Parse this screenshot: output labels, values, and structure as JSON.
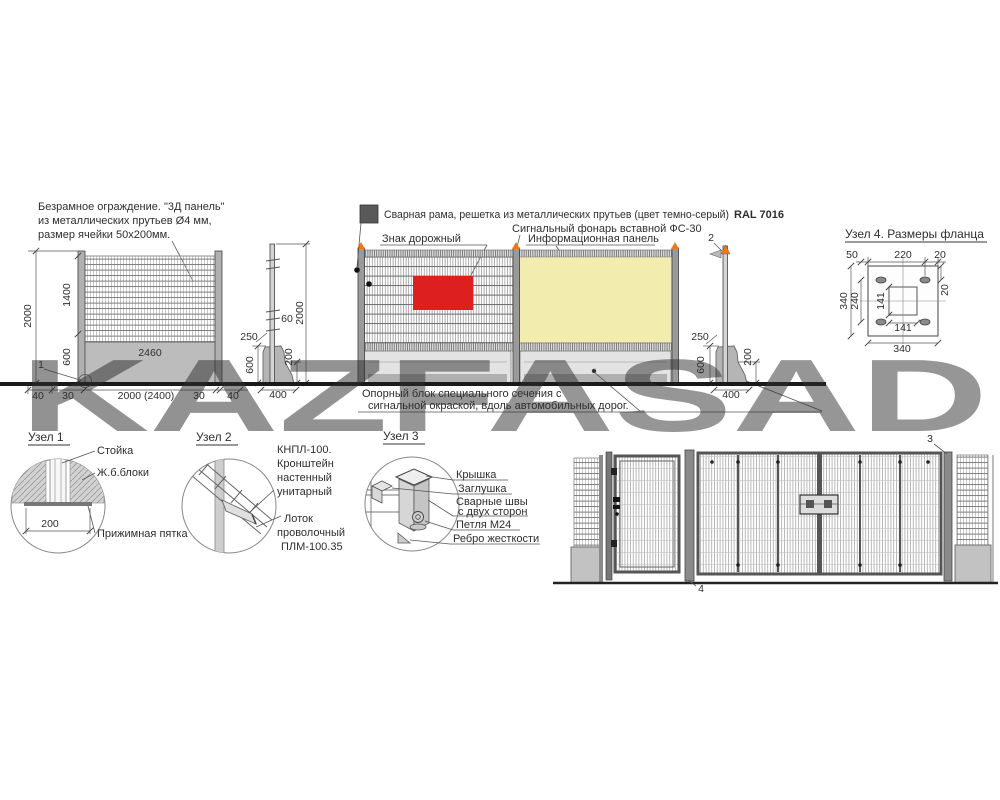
{
  "colors": {
    "sign_red": "#dd1f1f",
    "info_yellow": "#f2ecae",
    "lantern_orange": "#e8791e",
    "frame_swatch_gray": "#595959",
    "watermark_red": "#b33a33",
    "watermark_gray": "#9c9c9c"
  },
  "fence3d": {
    "description_line1": "Безрамное ограждение. \"3Д панель\"",
    "description_line2": "из металлических прутьев Ø4 мм,",
    "description_line3": "размер ячейки 50x200мм.",
    "dim_height_total": "2000",
    "dim_mesh_height": "1400",
    "dim_base_height": "600",
    "dim_block_width": "2460",
    "dim_edge_left": "40",
    "dim_gap_left": "30",
    "dim_span": "2000 (2400)",
    "dim_gap_right": "30",
    "dim_edge_right": "40",
    "item_no": "1"
  },
  "side1": {
    "dim_bracket": "60",
    "dim_height": "2000",
    "dim_top": "250",
    "dim_base_height": "600",
    "dim_base_top": "200",
    "dim_base_width": "400"
  },
  "frame": {
    "legend_text": "Сварная рама, решетка из металлических прутьев (цвет темно-серый)",
    "legend_code": "RAL 7016",
    "lantern_label": "Сигнальный фонарь вставной ФС-30",
    "sign_label": "Знак дорожный",
    "info_label": "Информационная панель",
    "support_line1": "Опорный блок специального сечения с",
    "support_line2": "сигнальной окраской, вдоль автомобильных дорог."
  },
  "side2": {
    "item_no": "2",
    "dim_top": "250",
    "dim_base_height": "600",
    "dim_base_top": "200",
    "dim_base_width": "400"
  },
  "node4": {
    "title": "Узел 4. Размеры фланца",
    "dim_top_left": "50",
    "dim_top_center": "220",
    "dim_top_right": "20",
    "dim_left_outer": "340",
    "dim_left_inner": "240",
    "dim_center_vert": "141",
    "dim_center_horiz": "141",
    "dim_slot_offset": "20",
    "dim_bottom": "340"
  },
  "node1": {
    "title": "Узел 1",
    "label_post": "Стойка",
    "label_blocks": "Ж.б.блоки",
    "dim_width": "200",
    "label_heel": "Прижимная пятка"
  },
  "node2": {
    "title": "Узел 2",
    "label_bracket_1": "КНПЛ-100.",
    "label_bracket_2": "Кронштейн",
    "label_bracket_3": "настенный",
    "label_bracket_4": "унитарный",
    "label_tray_1": "Лоток",
    "label_tray_2": "проволочный",
    "label_tray_3": "ПЛМ-100.35"
  },
  "node3": {
    "title": "Узел 3",
    "label_cap": "Крышка",
    "label_plug": "Заглушка",
    "label_weld_1": "Сварные швы",
    "label_weld_2": "с двух сторон",
    "label_loop": "Петля  М24",
    "label_rib": "Ребро жесткости"
  },
  "gate": {
    "item_3": "3",
    "item_4": "4"
  },
  "watermark": {
    "part1": "KAZ",
    "part2": "FASAD"
  }
}
